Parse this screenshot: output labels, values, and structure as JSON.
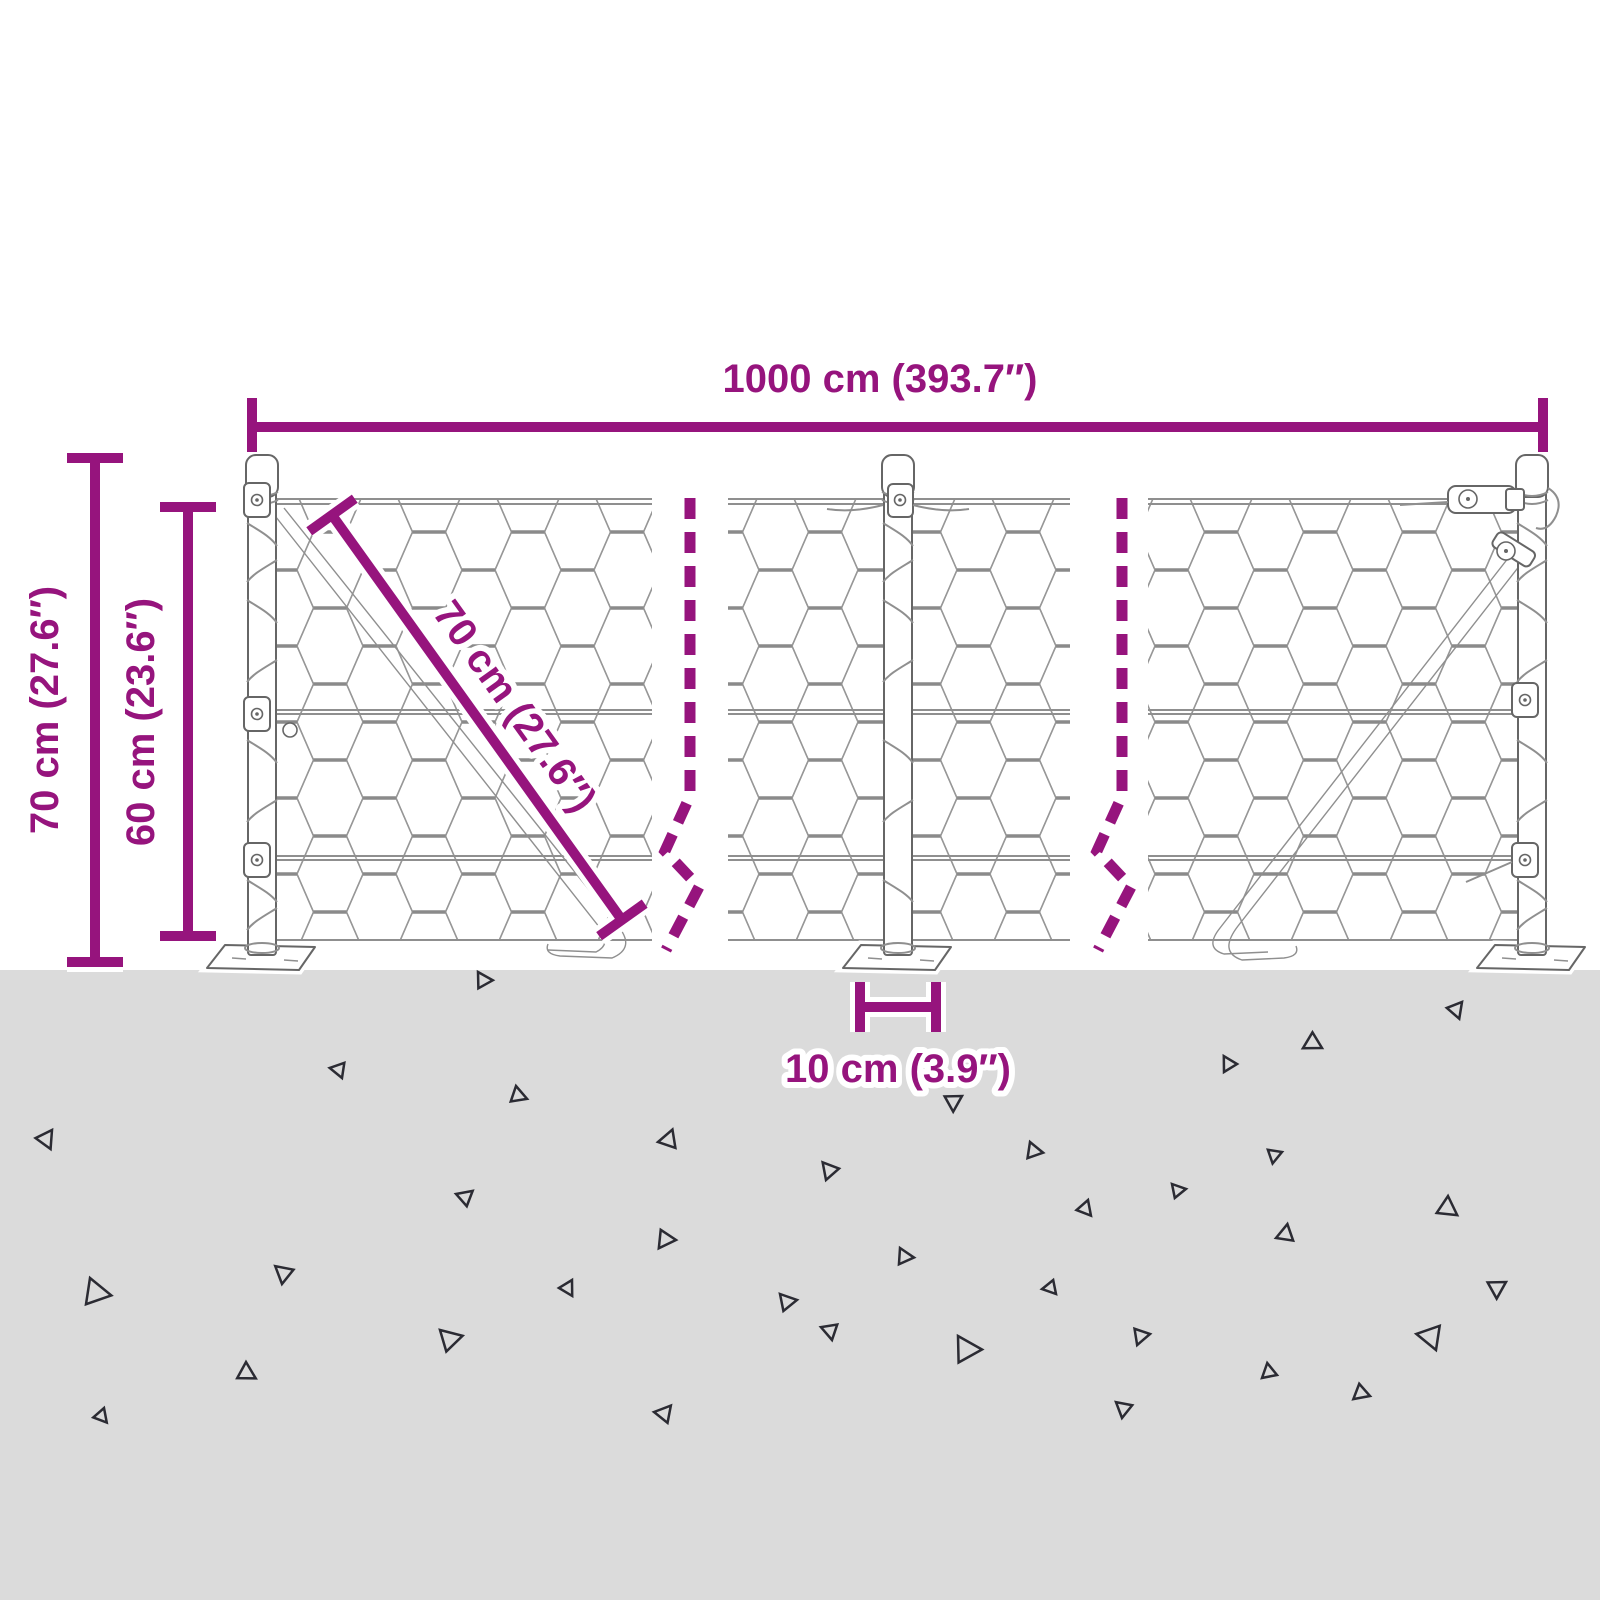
{
  "figure": {
    "kind": "product dimension diagram",
    "subject": "hexagonal wire mesh fence with three posts on ground"
  },
  "colors": {
    "background": "#FFFFFF",
    "ground": "#DBDBDB",
    "dimension": "#96147D",
    "halo": "#FFFFFF",
    "line_art": "#8F8F8F",
    "line_dark": "#666666",
    "triangle": "#2B2B33"
  },
  "dimensions": {
    "total_width": "1000 cm (393.7″)",
    "post_height": "70 cm (27.6″)",
    "mesh_height": "60 cm (23.6″)",
    "mesh_diagonal": "70 cm (27.6″)",
    "post_offset": "10 cm (3.9″)"
  },
  "ground": {
    "triangles": [
      {
        "x": 478,
        "y": 972,
        "s": 16,
        "r": 10
      },
      {
        "x": 1462,
        "y": 1002,
        "s": 16,
        "r": 80
      },
      {
        "x": 1322,
        "y": 1048,
        "s": 18,
        "r": 160
      },
      {
        "x": 1224,
        "y": 1072,
        "s": 15,
        "r": 250
      },
      {
        "x": 342,
        "y": 1078,
        "s": 15,
        "r": 200
      },
      {
        "x": 516,
        "y": 1086,
        "s": 16,
        "r": 30
      },
      {
        "x": 962,
        "y": 1096,
        "s": 17,
        "r": 100
      },
      {
        "x": 52,
        "y": 1130,
        "s": 18,
        "r": 75
      },
      {
        "x": 658,
        "y": 1142,
        "s": 18,
        "r": 300
      },
      {
        "x": 1030,
        "y": 1142,
        "s": 16,
        "r": 20
      },
      {
        "x": 1282,
        "y": 1152,
        "s": 14,
        "r": 110
      },
      {
        "x": 1448,
        "y": 1196,
        "s": 20,
        "r": 45
      },
      {
        "x": 826,
        "y": 1180,
        "s": 17,
        "r": 240
      },
      {
        "x": 1172,
        "y": 1184,
        "s": 14,
        "r": 0
      },
      {
        "x": 456,
        "y": 1194,
        "s": 16,
        "r": 330
      },
      {
        "x": 1088,
        "y": 1200,
        "s": 15,
        "r": 60
      },
      {
        "x": 676,
        "y": 1240,
        "s": 18,
        "r": 135
      },
      {
        "x": 900,
        "y": 1248,
        "s": 16,
        "r": 15
      },
      {
        "x": 1276,
        "y": 1238,
        "s": 17,
        "r": 290
      },
      {
        "x": 90,
        "y": 1278,
        "s": 26,
        "r": 20
      },
      {
        "x": 282,
        "y": 1284,
        "s": 18,
        "r": 230
      },
      {
        "x": 572,
        "y": 1280,
        "s": 15,
        "r": 70
      },
      {
        "x": 780,
        "y": 1294,
        "s": 17,
        "r": 0
      },
      {
        "x": 1056,
        "y": 1294,
        "s": 14,
        "r": 180
      },
      {
        "x": 1506,
        "y": 1282,
        "s": 18,
        "r": 100
      },
      {
        "x": 440,
        "y": 1330,
        "s": 22,
        "r": 355
      },
      {
        "x": 832,
        "y": 1340,
        "s": 16,
        "r": 210
      },
      {
        "x": 958,
        "y": 1336,
        "s": 26,
        "r": 10
      },
      {
        "x": 1150,
        "y": 1334,
        "s": 16,
        "r": 120
      },
      {
        "x": 1436,
        "y": 1350,
        "s": 24,
        "r": 200
      },
      {
        "x": 246,
        "y": 1362,
        "s": 18,
        "r": 40
      },
      {
        "x": 1262,
        "y": 1378,
        "s": 15,
        "r": 270
      },
      {
        "x": 1370,
        "y": 1396,
        "s": 16,
        "r": 150
      },
      {
        "x": 104,
        "y": 1408,
        "s": 14,
        "r": 60
      },
      {
        "x": 654,
        "y": 1412,
        "s": 17,
        "r": 320
      },
      {
        "x": 1122,
        "y": 1418,
        "s": 16,
        "r": 230
      }
    ]
  }
}
